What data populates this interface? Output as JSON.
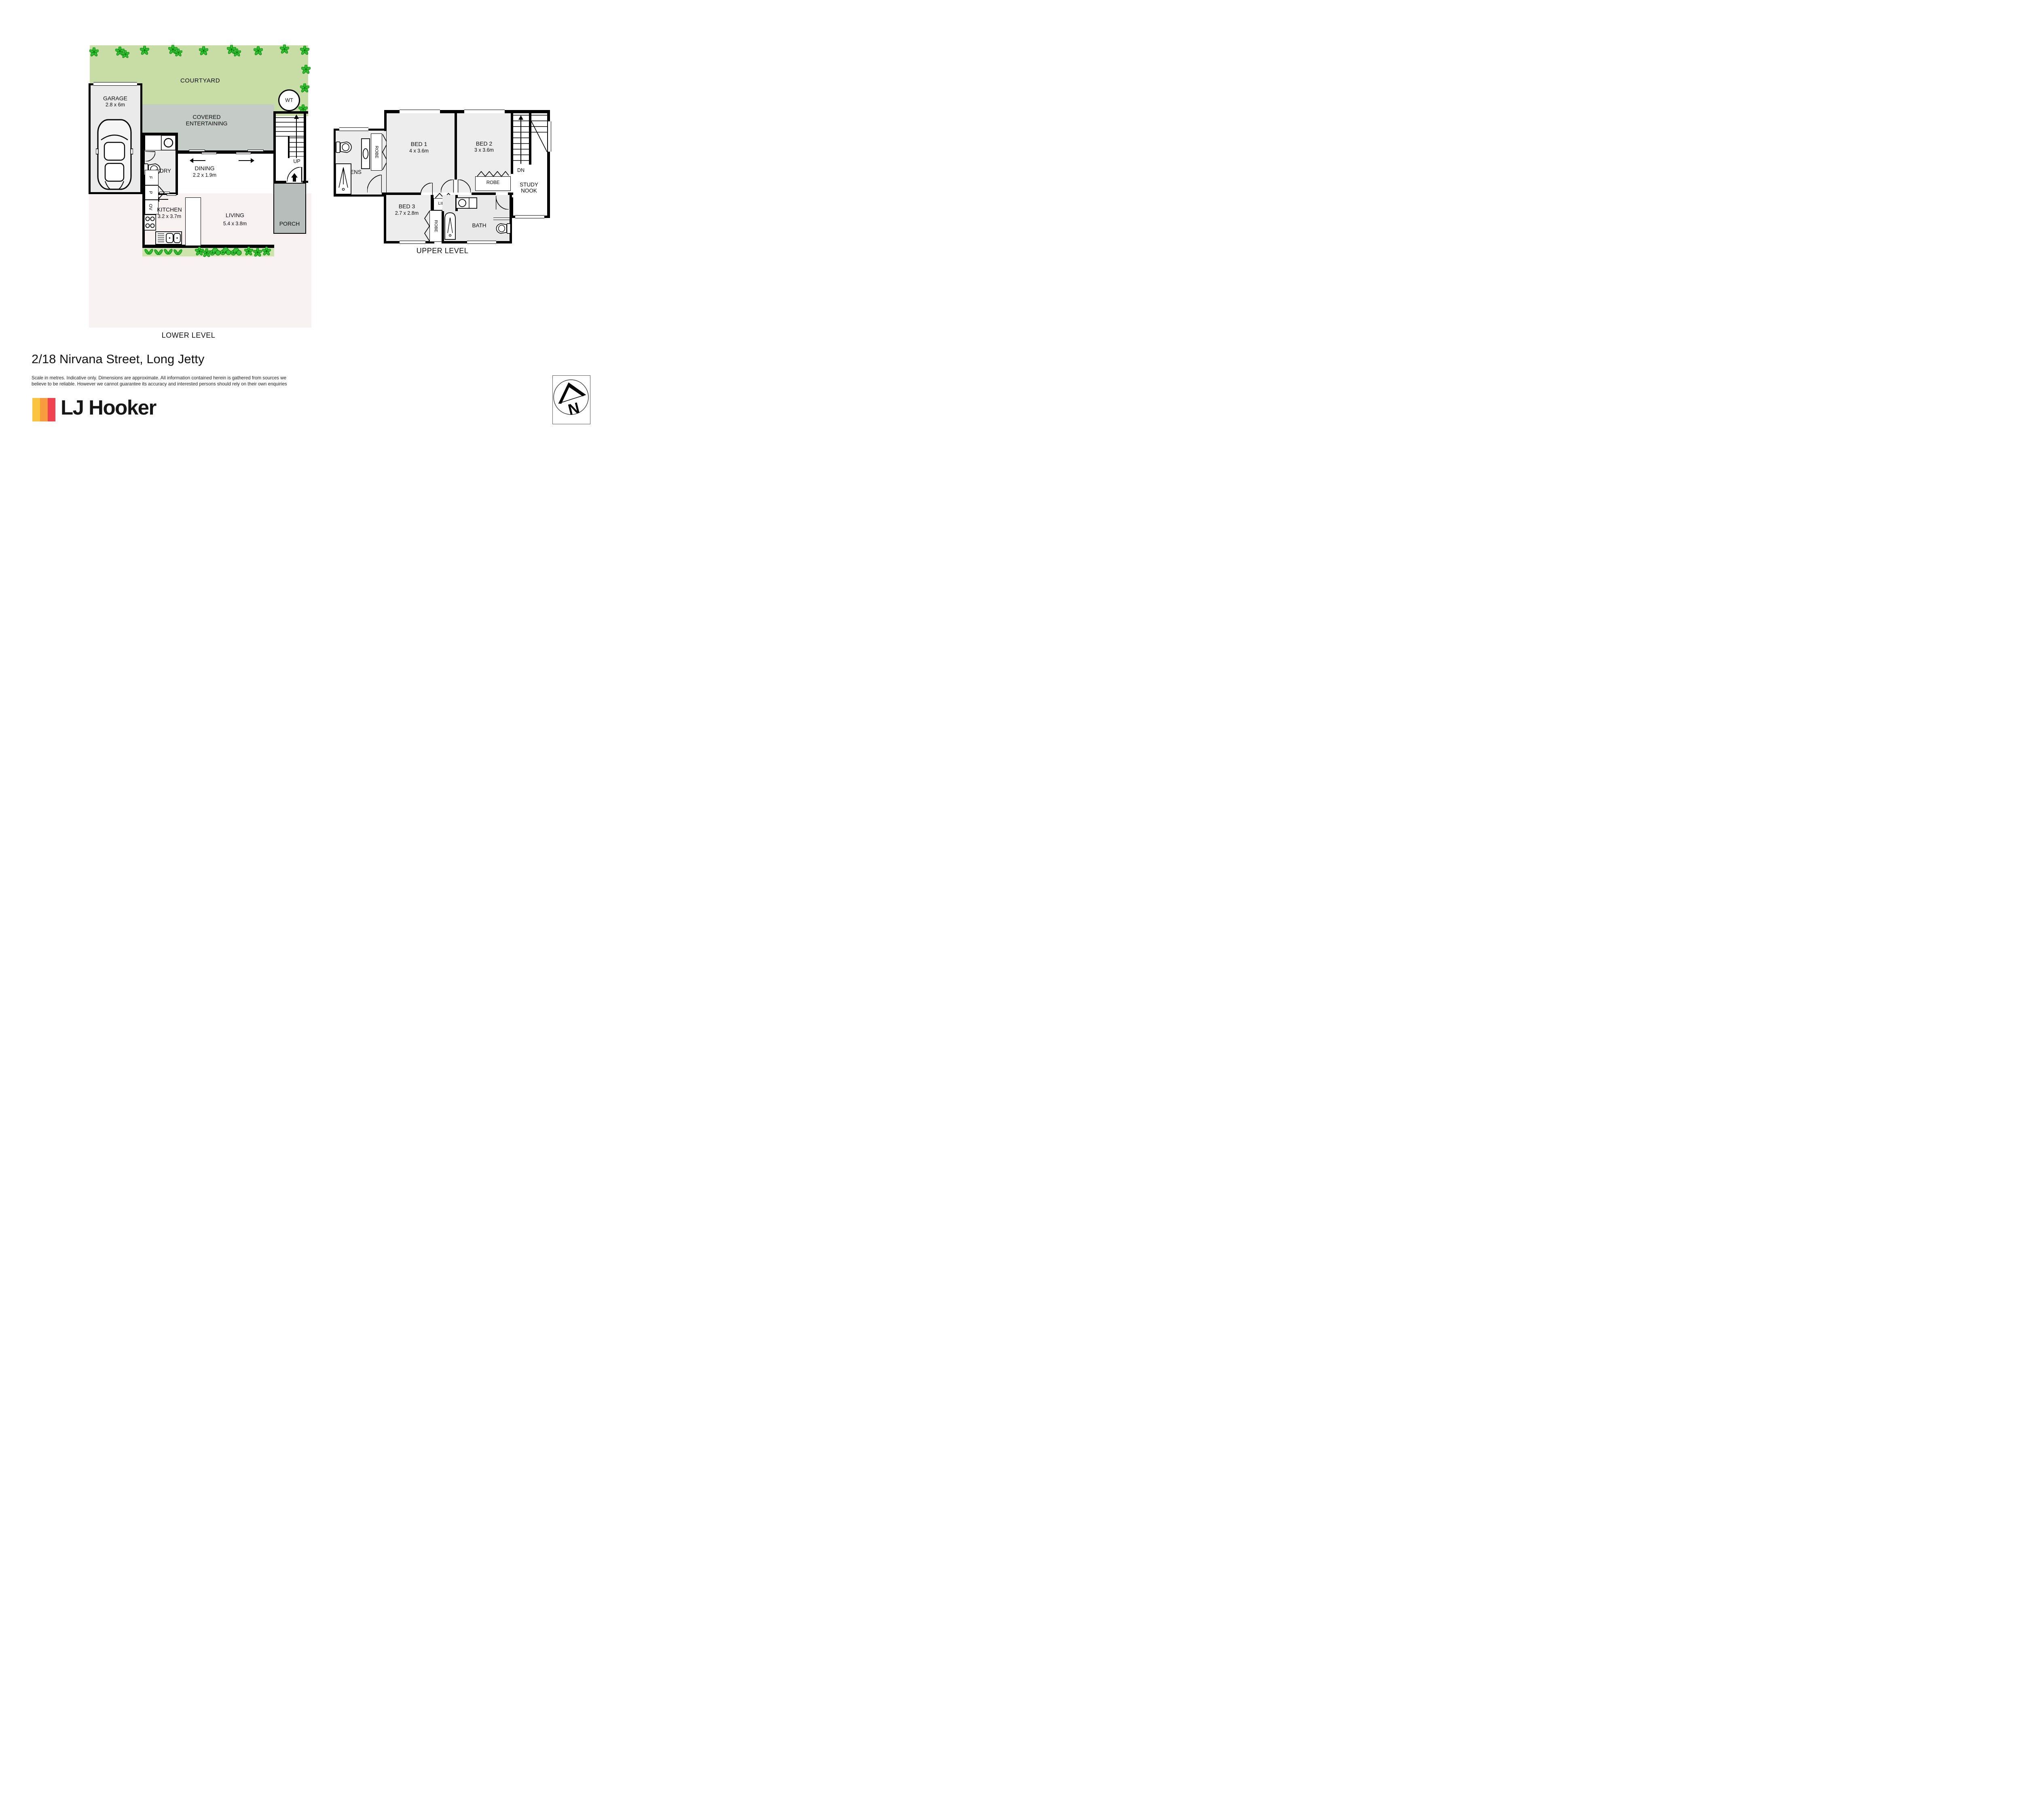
{
  "address": "2/18 Nirvana Street, Long Jetty",
  "disclaimer": {
    "line1": "Scale in metres. Indicative only. Dimensions are approximate. All information contained herein is gathered from sources we",
    "line2": "believe to be reliable. However we cannot guarantee its accuracy and interested persons should rely on their own enquiries"
  },
  "brand": {
    "name": "LJ Hooker"
  },
  "compass": {
    "north": "N"
  },
  "colors": {
    "courtyard_green": "#c8dda6",
    "plant_green": "#2ec02e",
    "covered_grey": "#c5cbc7",
    "porch_grey": "#b7bdba",
    "ground_pale": "#f7f1f2",
    "room_grey": "#ededed",
    "wall_black": "#000000",
    "logo_yellow": "#fbc440",
    "logo_orange": "#f79b3e",
    "logo_red": "#ef4450"
  },
  "lower": {
    "title": "LOWER LEVEL",
    "courtyard": "COURTYARD",
    "garage": {
      "name": "GARAGE",
      "dims": "2.8 x 6m"
    },
    "covered": {
      "line1": "COVERED",
      "line2": "ENTERTAINING"
    },
    "water_tank": "WT",
    "laundry": "L'DRY",
    "dining": {
      "name": "DINING",
      "dims": "2.2 x 1.9m"
    },
    "kitchen": {
      "name": "KITCHEN",
      "dims": "3.2 x 3.7m"
    },
    "living": {
      "name": "LIVING",
      "dims": "5.4 x 3.8m"
    },
    "porch": "PORCH",
    "stairs_up": "UP",
    "fridge": "F",
    "pantry": "P",
    "oven": "OV"
  },
  "upper": {
    "title": "UPPER LEVEL",
    "ensuite": "ENS",
    "robe_bed1": "ROBE",
    "bed1": {
      "name": "BED 1",
      "dims": "4 x 3.6m"
    },
    "bed2": {
      "name": "BED 2",
      "dims": "3 x 3.6m"
    },
    "robe_bed2": "ROBE",
    "stairs_down": "DN",
    "study": {
      "line1": "STUDY",
      "line2": "NOOK"
    },
    "bed3": {
      "name": "BED 3",
      "dims": "2.7 x 2.8m"
    },
    "linen": "LINEN",
    "robe_bed3": "ROBE",
    "bath": "BATH"
  }
}
